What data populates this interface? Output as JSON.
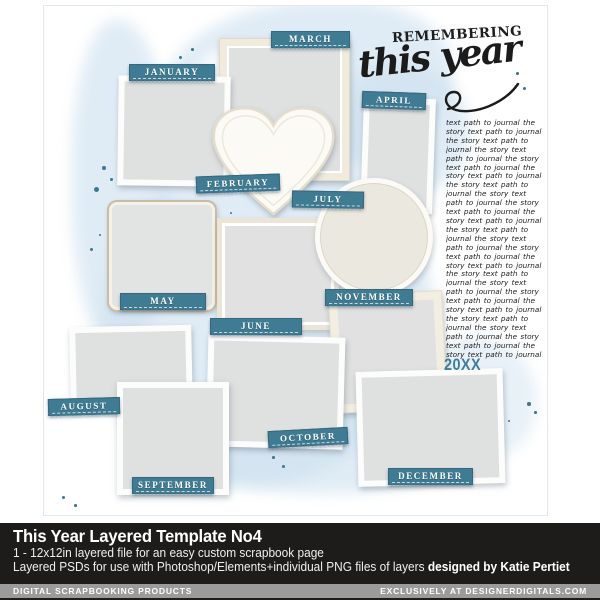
{
  "page": {
    "months": [
      "JANUARY",
      "FEBRUARY",
      "MARCH",
      "APRIL",
      "MAY",
      "JUNE",
      "JULY",
      "AUGUST",
      "SEPTEMBER",
      "OCTOBER",
      "NOVEMBER",
      "DECEMBER"
    ],
    "title_line1": "REMEMBERING",
    "title_line2": "this year",
    "year": "20XX",
    "journal_text": "text path to journal the story text path to journal the story text path to journal the story text path to journal the story text path to journal the story text path to journal the story text path to journal the story text path to journal the story text path to journal the story text path to journal the story text path to journal the story text path to journal the story text path to journal the story text path to journal the story text path to journal the story text path to journal the story text path to journal the story text path to journal the story text path to journal the story text path to journal the story text path to journal the story text path to journal"
  },
  "footer": {
    "product_title": "This Year Layered Template No4",
    "subtitle": "1 - 12x12in layered file for an easy custom scrapbook page",
    "description": "Layered PSDs for use with Photoshop/Elements+individual PNG files of layers",
    "designer_credit": "designed by Katie Pertiet",
    "brand_left": "DIGITAL SCRAPBOOKING PRODUCTS",
    "brand_right": "EXCLUSIVELY AT DESIGNERDIGITALS.COM"
  },
  "colors": {
    "label_teal": "#3f7b93",
    "year_teal": "#3f7e98",
    "splatter_teal": "#3c7891",
    "wash_blue": "#cbe0ee",
    "frame_cream": "#f3eee2",
    "photo_gray": "#dfe0e0",
    "footer_dark": "#1d1c1a",
    "footer_gray": "#9b9b9b"
  }
}
